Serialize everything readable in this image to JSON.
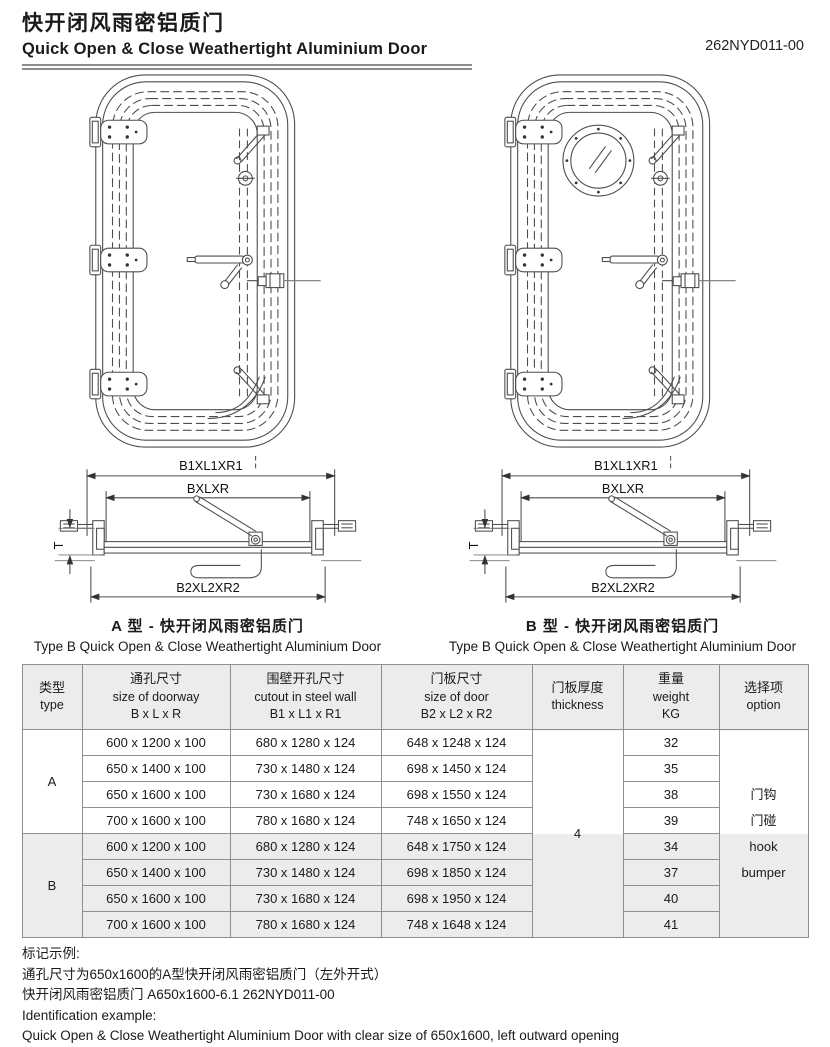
{
  "header": {
    "title_zh": "快开闭风雨密铝质门",
    "title_en": "Quick Open & Close Weathertight Aluminium Door",
    "doc_number": "262NYD011-00"
  },
  "drawings": {
    "type_a": {
      "dim_top": "B1XL1XR1",
      "dim_mid": "BXLXR",
      "dim_bottom": "B2XL2XR2",
      "dim_thickness": "T",
      "caption_zh": "A 型 - 快开闭风雨密铝质门",
      "caption_en": "Type B Quick Open & Close Weathertight Aluminium Door"
    },
    "type_b": {
      "dim_top": "B1XL1XR1",
      "dim_mid": "BXLXR",
      "dim_bottom": "B2XL2XR2",
      "dim_thickness": "T",
      "caption_zh": "B 型 - 快开闭风雨密铝质门",
      "caption_en": "Type B Quick Open & Close Weathertight Aluminium Door"
    }
  },
  "table": {
    "headers": {
      "type_zh": "类型",
      "type_en": "type",
      "doorway_zh": "通孔尺寸",
      "doorway_en": "size of doorway",
      "doorway_dims": "B x L x R",
      "cutout_zh": "围壁开孔尺寸",
      "cutout_en": "cutout in steel wall",
      "cutout_dims": "B1 x L1 x R1",
      "door_zh": "门板尺寸",
      "door_en": "size of door",
      "door_dims": "B2 x L2 x R2",
      "thickness_zh": "门板厚度",
      "thickness_en": "thickness",
      "weight_zh": "重量",
      "weight_en": "weight",
      "weight_unit": "KG",
      "option_zh": "选择项",
      "option_en": "option"
    },
    "thickness_value": "4",
    "option_lines": [
      "门钩",
      "门碰",
      "hook",
      "bumper"
    ],
    "groups": [
      {
        "type": "A",
        "rows": [
          {
            "doorway": "600 x 1200 x 100",
            "cutout": "680 x 1280 x 124",
            "door": "648 x 1248 x 124",
            "weight": "32"
          },
          {
            "doorway": "650 x 1400 x 100",
            "cutout": "730 x 1480 x 124",
            "door": "698 x 1450 x 124",
            "weight": "35"
          },
          {
            "doorway": "650 x 1600 x 100",
            "cutout": "730 x 1680 x 124",
            "door": "698 x 1550 x 124",
            "weight": "38"
          },
          {
            "doorway": "700 x 1600 x 100",
            "cutout": "780 x 1680 x 124",
            "door": "748 x 1650 x 124",
            "weight": "39"
          }
        ]
      },
      {
        "type": "B",
        "rows": [
          {
            "doorway": "600 x 1200 x 100",
            "cutout": "680 x 1280 x 124",
            "door": "648 x 1750 x 124",
            "weight": "34"
          },
          {
            "doorway": "650 x 1400 x 100",
            "cutout": "730 x 1480 x 124",
            "door": "698 x 1850 x 124",
            "weight": "37"
          },
          {
            "doorway": "650 x 1600 x 100",
            "cutout": "730 x 1680 x 124",
            "door": "698 x 1950 x 124",
            "weight": "40"
          },
          {
            "doorway": "700 x 1600 x 100",
            "cutout": "780 x 1680 x 124",
            "door": "748 x 1648 x 124",
            "weight": "41"
          }
        ]
      }
    ]
  },
  "footer": {
    "label_zh": "标记示例:",
    "line1_zh": "通孔尺寸为650x1600的A型快开闭风雨密铝质门（左外开式）",
    "line2_zh": "快开闭风雨密铝质门 A650x1600-6.1 262NYD011-00",
    "label_en": "Identification example:",
    "line1_en": "Quick Open & Close Weathertight Aluminium Door with clear size of 650x1600, left outward opening",
    "line2_en": "Quick Open & Close Weathertight Aluminium Door 650x1600 262NYD011-00"
  },
  "colors": {
    "line": "#4d4d4d",
    "table_border": "#8f8f8f",
    "shade": "#ececec"
  }
}
